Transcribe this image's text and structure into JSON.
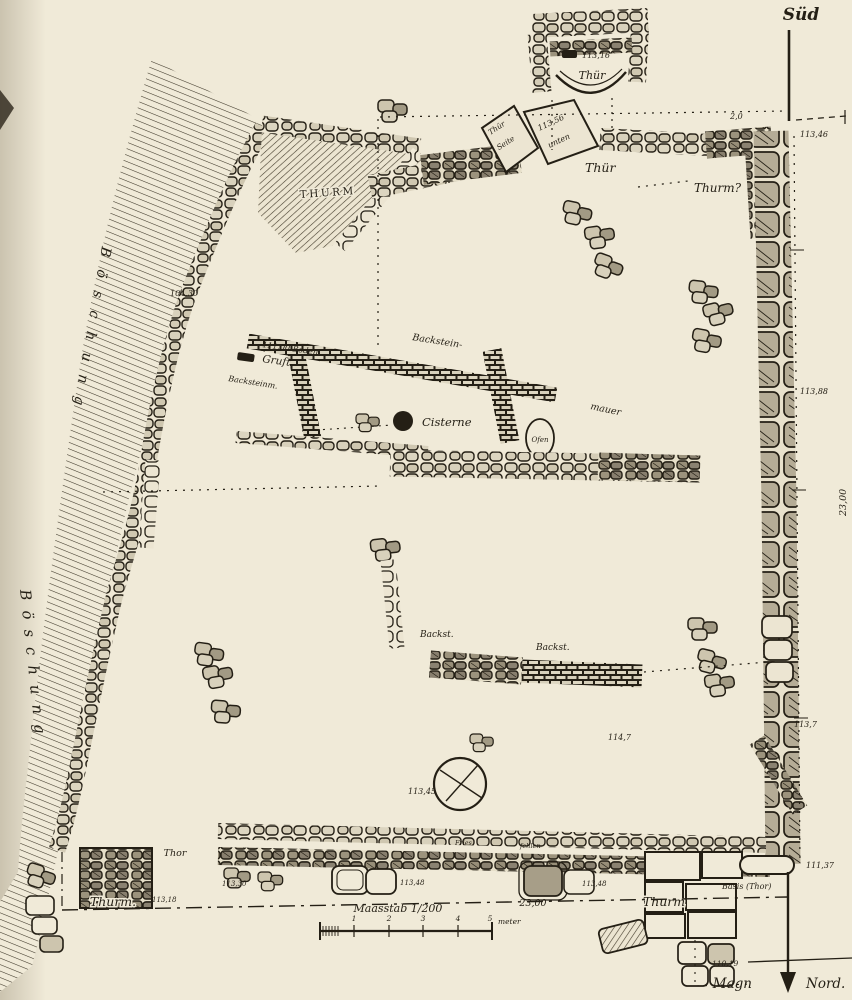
{
  "title": "Grabungsplan einer Befestigung (Steinplan)",
  "colors": {
    "paper": "#f0ead8",
    "ink": "#241f15"
  },
  "compass": {
    "south_label": "Süd",
    "north_label_left": "Magn",
    "north_label_right": "Nord."
  },
  "scale_bar": {
    "label": "Maasstab 1/200",
    "unit": "meter",
    "ticks": [
      "1",
      "2",
      "3",
      "4",
      "5"
    ],
    "baseline_distance": "23,00"
  },
  "labels": {
    "thuer_apse": "Thür",
    "stone_thuer_l1": "Thür",
    "stone_thuer_l2": "Seite",
    "stone_elev_l1": "113,56",
    "stone_elev_l2": "unten",
    "thuer_east": "Thür",
    "thurm_nw": "Thurm",
    "thurm_ne": "Thurm?",
    "backstein_1": "Backstein-",
    "backstein_2": "mauer",
    "backsteinm": "Backsteinm.",
    "boden": "111,00 Boden",
    "gruft": "Gruft",
    "cisterne": "Cisterne",
    "ofen": "Ofen",
    "backst_a": "Backst.",
    "backst_b": "Backst.",
    "boeschung_a": "Böschung",
    "boeschung_b": "Böschung",
    "thor": "Thor",
    "thurm_sw": "Thurm.",
    "thurm_se": "Thurm",
    "basis_thor": "Basis (Thor)",
    "fries": "Fries",
    "fehlen": "fehlen"
  },
  "elevations": {
    "e_2_0": "2,0",
    "e_113_46": "113,46",
    "e_104_30": "104,30",
    "e_113_16": "113,16",
    "e_113_88": "113,88",
    "e_23_00_right": "23,00",
    "e_113_7": "113,7",
    "e_114_7": "114,7",
    "e_113_45": "113,45",
    "e_111_37": "111,37",
    "e_113_48_a": "113,48",
    "e_113_48_b": "113,48",
    "e_113_30": "113,30",
    "e_113_18": "113,18",
    "e_110_19": "110,19"
  }
}
